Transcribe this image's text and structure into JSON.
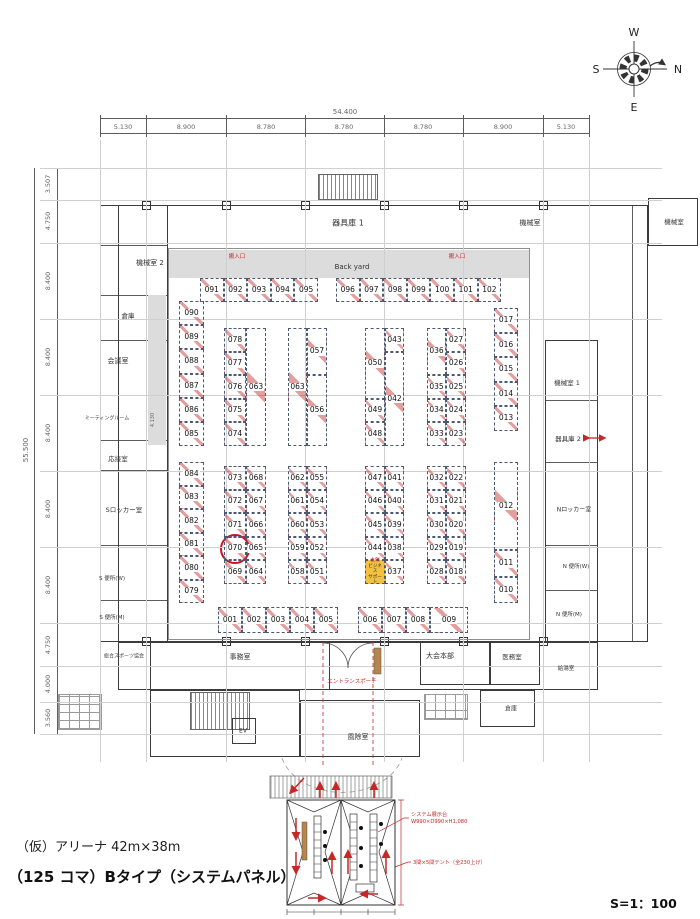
{
  "footer": {
    "line1": "（仮）アリーナ 42m×38m",
    "line2": "（125 コマ）Bタイプ（システムパネル）",
    "scale": "S=1：100"
  },
  "compass": {
    "top": "W",
    "right": "N",
    "bottom": "E",
    "left": "S"
  },
  "dimensions": {
    "top_total": "54.400",
    "top_segments": [
      "5.130",
      "8.900",
      "8.780",
      "8.780",
      "8.780",
      "8.900",
      "5.130"
    ],
    "left_total": "55.500",
    "left_segments": [
      "3.507",
      "4.750",
      "8.400",
      "8.400",
      "8.400",
      "8.400",
      "8.400",
      "4.750",
      "4.000",
      "3.560"
    ],
    "corridor": "4.130"
  },
  "rooms": [
    {
      "id": "equip-store-1",
      "label": "器具庫 1"
    },
    {
      "id": "machine-room-top",
      "label": "機械室"
    },
    {
      "id": "machine-room-annex",
      "label": "機械室"
    },
    {
      "id": "machine-room-2",
      "label": "機械室 2"
    },
    {
      "id": "storage-left",
      "label": "倉庫"
    },
    {
      "id": "conference-room",
      "label": "会議室"
    },
    {
      "id": "meeting-room",
      "label": "ミーティングルーム"
    },
    {
      "id": "reception-room",
      "label": "応接室"
    },
    {
      "id": "s-locker-room",
      "label": "Sロッカー室"
    },
    {
      "id": "s-toilet-w",
      "label": "S 便所(W)"
    },
    {
      "id": "s-toilet-m",
      "label": "S 便所(M)"
    },
    {
      "id": "sports-assoc",
      "label": "総合スポーツ協会"
    },
    {
      "id": "back-yard",
      "label": "Back yard"
    },
    {
      "id": "machine-room-1",
      "label": "機械室 1"
    },
    {
      "id": "equip-store-2",
      "label": "器具庫 2"
    },
    {
      "id": "n-locker-room",
      "label": "Nロッカー室"
    },
    {
      "id": "n-toilet-w",
      "label": "N 便所(W)"
    },
    {
      "id": "n-toilet-m",
      "label": "N 便所(M)"
    },
    {
      "id": "office",
      "label": "事務室"
    },
    {
      "id": "hq",
      "label": "大会本部"
    },
    {
      "id": "medical",
      "label": "医務室"
    },
    {
      "id": "kitchenette",
      "label": "給湯室"
    },
    {
      "id": "storage-br",
      "label": "倉庫"
    },
    {
      "id": "windbreak",
      "label": "風除室"
    },
    {
      "id": "elevator",
      "label": "EV"
    }
  ],
  "red_labels": {
    "loading1": "搬入口",
    "loading2": "搬入口",
    "entrance": "エントランスポーチ"
  },
  "booths": {
    "top_row": {
      "left": [
        "091",
        "092",
        "093",
        "094",
        "095"
      ],
      "right": [
        "096",
        "097",
        "098",
        "099",
        "100",
        "101",
        "102"
      ]
    },
    "bottom_row": {
      "left": [
        "001",
        "002",
        "003",
        "004",
        "005"
      ],
      "right": [
        "006",
        "007",
        "008"
      ],
      "wide": "009"
    },
    "left_wall_top": [
      "090",
      "089",
      "088",
      "087",
      "086",
      "085"
    ],
    "left_wall_bottom": [
      "084",
      "083",
      "082",
      "081",
      "080",
      "079"
    ],
    "right_wall_top": [
      "017",
      "016",
      "015",
      "014",
      "013"
    ],
    "right_wall_bottom": [
      "012",
      "011",
      "010"
    ],
    "top_blocks": [
      {
        "left": [
          {
            "n": "078"
          },
          {
            "n": "077"
          },
          {
            "n": "076"
          },
          {
            "n": "075"
          },
          {
            "n": "074"
          }
        ],
        "right": [
          {
            "n": "063",
            "span": 5
          }
        ]
      },
      {
        "left": [
          {
            "n": "063",
            "span": 5
          }
        ],
        "right": [
          {
            "n": "057",
            "span": 2
          },
          {
            "n": "056",
            "span": 3
          }
        ]
      },
      {
        "left": [
          {
            "n": "050",
            "span": 3
          },
          {
            "n": "049"
          },
          {
            "n": "048"
          }
        ],
        "right": [
          {
            "n": "043"
          },
          {
            "n": "042",
            "span": 4
          }
        ]
      },
      {
        "left": [
          {
            "n": "036",
            "span": 2
          },
          {
            "n": "035"
          },
          {
            "n": "034"
          },
          {
            "n": "033"
          }
        ],
        "right": [
          {
            "n": "027"
          },
          {
            "n": "026"
          },
          {
            "n": "025"
          },
          {
            "n": "024"
          },
          {
            "n": "023"
          }
        ]
      }
    ],
    "bottom_blocks": [
      {
        "left": [
          {
            "n": "073"
          },
          {
            "n": "072"
          },
          {
            "n": "071"
          },
          {
            "n": "070",
            "circled": true
          },
          {
            "n": "069"
          }
        ],
        "right": [
          {
            "n": "068"
          },
          {
            "n": "067"
          },
          {
            "n": "066"
          },
          {
            "n": "065"
          },
          {
            "n": "064"
          }
        ]
      },
      {
        "left": [
          {
            "n": "062"
          },
          {
            "n": "061"
          },
          {
            "n": "060"
          },
          {
            "n": "059"
          },
          {
            "n": "058"
          }
        ],
        "right": [
          {
            "n": "055"
          },
          {
            "n": "054"
          },
          {
            "n": "053"
          },
          {
            "n": "052"
          },
          {
            "n": "051"
          }
        ]
      },
      {
        "left": [
          {
            "n": "047"
          },
          {
            "n": "046"
          },
          {
            "n": "045"
          },
          {
            "n": "044"
          },
          {
            "organizer": true
          }
        ],
        "right": [
          {
            "n": "041"
          },
          {
            "n": "040"
          },
          {
            "n": "039"
          },
          {
            "n": "038"
          },
          {
            "n": "037"
          }
        ]
      },
      {
        "left": [
          {
            "n": "032"
          },
          {
            "n": "031"
          },
          {
            "n": "030"
          },
          {
            "n": "029"
          },
          {
            "n": "028"
          }
        ],
        "right": [
          {
            "n": "022"
          },
          {
            "n": "021"
          },
          {
            "n": "020"
          },
          {
            "n": "019"
          },
          {
            "n": "018"
          }
        ]
      }
    ]
  },
  "organizer_cell": {
    "lines": [
      "主催",
      "ビジネス",
      "サポート"
    ],
    "color": "#f2c23e"
  },
  "highlight": {
    "booth": "070",
    "color": "#cc1122"
  },
  "inset": {
    "annotation1a": "システム展示台",
    "annotation1b": "W990×D990×H1,080",
    "annotation2": "3間×5間テント（全230上げ）"
  },
  "colors": {
    "booth_line": "#4a5a74",
    "red": "#c62828",
    "backyard_gray": "#dcdcdc",
    "organizer_yellow": "#f2c23e",
    "tan": "#b5854a"
  }
}
